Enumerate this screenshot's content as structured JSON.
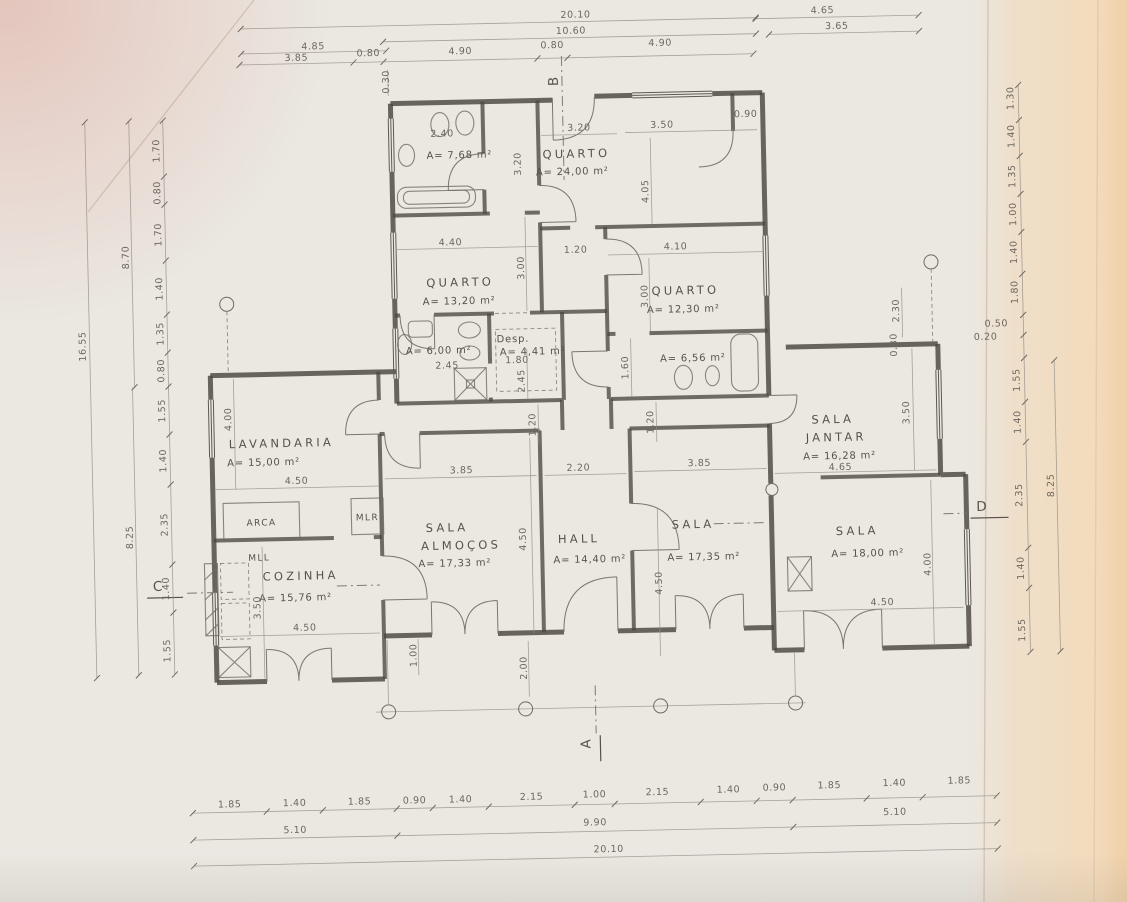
{
  "plan": {
    "rooms": [
      {
        "name": "QUARTO",
        "area": "A= 24,00 m²"
      },
      {
        "name": "QUARTO",
        "area": "A= 13,20 m²"
      },
      {
        "name": "QUARTO",
        "area": "A= 12,30 m²"
      },
      {
        "name": "",
        "area": "A= 7,68 m²"
      },
      {
        "name": "",
        "area": "A= 6,00 m²"
      },
      {
        "name": "Desp.",
        "area": "A= 4,41 m²"
      },
      {
        "name": "",
        "area": "A= 6,56 m²"
      },
      {
        "name": "LAVANDARIA",
        "area": "A= 15,00 m²"
      },
      {
        "name": "SALA",
        "name2": "JANTAR",
        "area": "A= 16,28 m²"
      },
      {
        "name": "SALA",
        "name2": "ALMOÇOS",
        "area": "A= 17,33 m²"
      },
      {
        "name": "HALL",
        "area": "A= 14,40 m²"
      },
      {
        "name": "SALA",
        "area": "A= 17,35 m²"
      },
      {
        "name": "SALA",
        "area": "A= 18,00 m²"
      },
      {
        "name": "COZINHA",
        "area": "A= 15,76 m²"
      }
    ],
    "fixtures": {
      "arca": "ARCA",
      "mlr": "MLR",
      "mll": "MLL"
    },
    "markers": {
      "a": "A",
      "b": "B",
      "c": "C",
      "d": "D"
    },
    "dims": {
      "top": [
        "20.10",
        "10.60",
        "4.85",
        "3.85",
        "0.80",
        "4.90",
        "0.80",
        "4.90",
        "0.30",
        "4.65",
        "3.65"
      ],
      "bottom_row1": [
        "1.85",
        "1.40",
        "1.85",
        "0.90",
        "1.40",
        "2.15",
        "1.00",
        "2.15",
        "1.40",
        "0.90",
        "1.85",
        "1.40",
        "1.85"
      ],
      "bottom_row2": [
        "5.10",
        "9.90",
        "5.10"
      ],
      "bottom_total": "20.10",
      "left": [
        "1.70",
        "0.80",
        "1.70",
        "1.40",
        "1.35",
        "0.80",
        "1.55",
        "1.40",
        "2.35",
        "1.40",
        "1.55"
      ],
      "left_outer": [
        "8.70",
        "16.55",
        "8.25"
      ],
      "right": [
        "1.30",
        "1.40",
        "1.35",
        "1.00",
        "1.40",
        "1.80",
        "1.55",
        "1.40",
        "2.35",
        "1.40",
        "1.55"
      ],
      "right_outer": [
        "0.50",
        "0.20",
        "8.25"
      ],
      "inner": [
        "2.40",
        "3.20",
        "3.20",
        "3.50",
        "0.90",
        "4.05",
        "4.40",
        "3.00",
        "1.20",
        "4.10",
        "3.00",
        "2.45",
        "1.80",
        "2.45",
        "1.60",
        "2.30",
        "0.30",
        "4.00",
        "4.50",
        "3.85",
        "4.50",
        "2.20",
        "3.85",
        "4.65",
        "3.50",
        "4.50",
        "4.50",
        "4.00",
        "3.50",
        "4.50",
        "1.00",
        "2.00",
        "1.20",
        "1.20"
      ]
    }
  }
}
